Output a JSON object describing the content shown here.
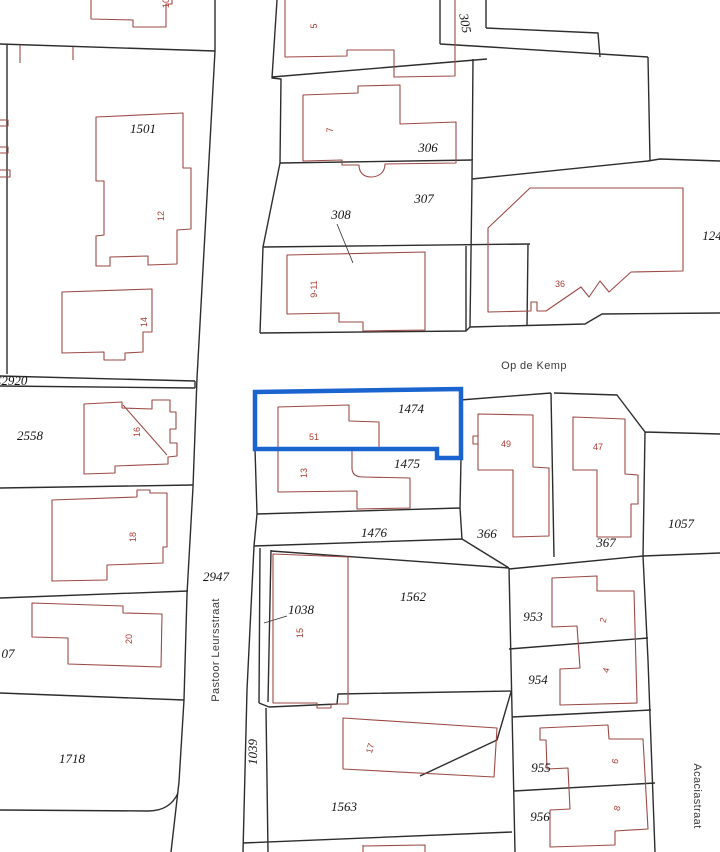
{
  "map": {
    "title": "cadastral-parcel-map",
    "background": "#ffffff",
    "colors": {
      "boundary": "#2d2d2d",
      "building": "#9c4a46",
      "highlight": "#1a64cf",
      "parcel_label": "#141414",
      "house_number": "#ae3c34",
      "street_label": "#3a3a3a"
    },
    "highlighted_parcel": {
      "parcel_number": "1474",
      "house_number": "51"
    },
    "parcel_labels": [
      {
        "text": "1501",
        "x": 143,
        "y": 133
      },
      {
        "text": "305",
        "x": 461,
        "y": 24,
        "rotate": 80
      },
      {
        "text": "306",
        "x": 428,
        "y": 152
      },
      {
        "text": "307",
        "x": 424,
        "y": 203
      },
      {
        "text": "308",
        "x": 341,
        "y": 219
      },
      {
        "text": "124",
        "x": 712,
        "y": 240
      },
      {
        "text": "C2920",
        "x": 10,
        "y": 385
      },
      {
        "text": "2558",
        "x": 30,
        "y": 440
      },
      {
        "text": "1474",
        "x": 411,
        "y": 413
      },
      {
        "text": "1475",
        "x": 407,
        "y": 468
      },
      {
        "text": "1476",
        "x": 374,
        "y": 537
      },
      {
        "text": "366",
        "x": 487,
        "y": 538
      },
      {
        "text": "367",
        "x": 606,
        "y": 547
      },
      {
        "text": "1057",
        "x": 681,
        "y": 528
      },
      {
        "text": "2947",
        "x": 216,
        "y": 581
      },
      {
        "text": "1562",
        "x": 413,
        "y": 601
      },
      {
        "text": "1038",
        "x": 301,
        "y": 614
      },
      {
        "text": "953",
        "x": 533,
        "y": 621
      },
      {
        "text": "954",
        "x": 538,
        "y": 684
      },
      {
        "text": "07",
        "x": 8,
        "y": 658
      },
      {
        "text": "1718",
        "x": 72,
        "y": 763
      },
      {
        "text": "1039",
        "x": 257,
        "y": 752,
        "rotate": -90
      },
      {
        "text": "955",
        "x": 541,
        "y": 772
      },
      {
        "text": "1563",
        "x": 344,
        "y": 811
      },
      {
        "text": "956",
        "x": 540,
        "y": 821
      }
    ],
    "house_numbers": [
      {
        "text": "10",
        "x": 169,
        "y": 3,
        "rotate": -90
      },
      {
        "text": "5",
        "x": 317,
        "y": 26,
        "rotate": -90
      },
      {
        "text": "7",
        "x": 333,
        "y": 130,
        "rotate": -90
      },
      {
        "text": "12",
        "x": 164,
        "y": 216,
        "rotate": -90
      },
      {
        "text": "9-11",
        "x": 317,
        "y": 289,
        "rotate": -90
      },
      {
        "text": "36",
        "x": 560,
        "y": 287
      },
      {
        "text": "14",
        "x": 147,
        "y": 322,
        "rotate": -90
      },
      {
        "text": "16",
        "x": 140,
        "y": 432,
        "rotate": -90
      },
      {
        "text": "51",
        "x": 314,
        "y": 440
      },
      {
        "text": "49",
        "x": 506,
        "y": 447
      },
      {
        "text": "47",
        "x": 598,
        "y": 450
      },
      {
        "text": "13",
        "x": 307,
        "y": 473,
        "rotate": -90
      },
      {
        "text": "18",
        "x": 136,
        "y": 537,
        "rotate": -90
      },
      {
        "text": "2",
        "x": 606,
        "y": 621,
        "rotate": -75
      },
      {
        "text": "15",
        "x": 303,
        "y": 633,
        "rotate": -90
      },
      {
        "text": "20",
        "x": 132,
        "y": 639,
        "rotate": -90
      },
      {
        "text": "4",
        "x": 609,
        "y": 671,
        "rotate": -75
      },
      {
        "text": "17",
        "x": 373,
        "y": 749,
        "rotate": -75
      },
      {
        "text": "6",
        "x": 618,
        "y": 762,
        "rotate": -75
      },
      {
        "text": "8",
        "x": 620,
        "y": 809,
        "rotate": -75
      }
    ],
    "street_names": [
      {
        "text": "Op de Kemp",
        "x": 534,
        "y": 369
      },
      {
        "text": "Pastoor Leursstraat",
        "x": 219,
        "y": 650,
        "rotate": -90
      },
      {
        "text": "Acaciastraat",
        "x": 694,
        "y": 796,
        "rotate": 90
      }
    ]
  }
}
